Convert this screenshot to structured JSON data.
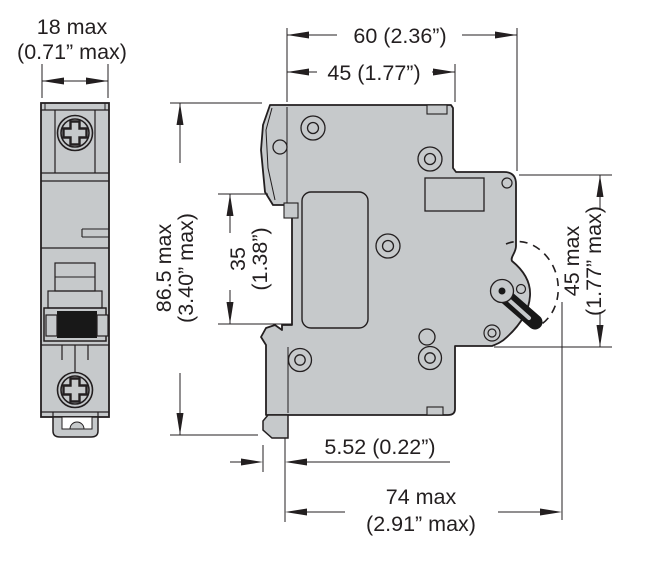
{
  "drawing": {
    "kind": "dimension-outline-drawing",
    "subject": "single-pole miniature circuit breaker, front view and side view"
  },
  "dimensions": {
    "front_width": {
      "line1": "18 max",
      "line2": "(0.71” max)"
    },
    "depth_total": {
      "label": "60 (2.36”)"
    },
    "depth_body": {
      "label": "45 (1.77”)"
    },
    "height_total": {
      "line1": "86.5 max",
      "line2": "(3.40” max)"
    },
    "din_channel": {
      "line1": "35",
      "line2": "(1.38”)"
    },
    "handle_zone": {
      "line1": "45 max",
      "line2": "(1.77” max)"
    },
    "clip_protrusion": {
      "label": "5.52 (0.22”)"
    },
    "depth_with_handle": {
      "line1": "74 max",
      "line2": "(2.91” max)"
    }
  },
  "colors": {
    "line": "#231f20",
    "body_fill": "#c6c9cb",
    "handle_fill": "#181818",
    "background": "#ffffff"
  }
}
